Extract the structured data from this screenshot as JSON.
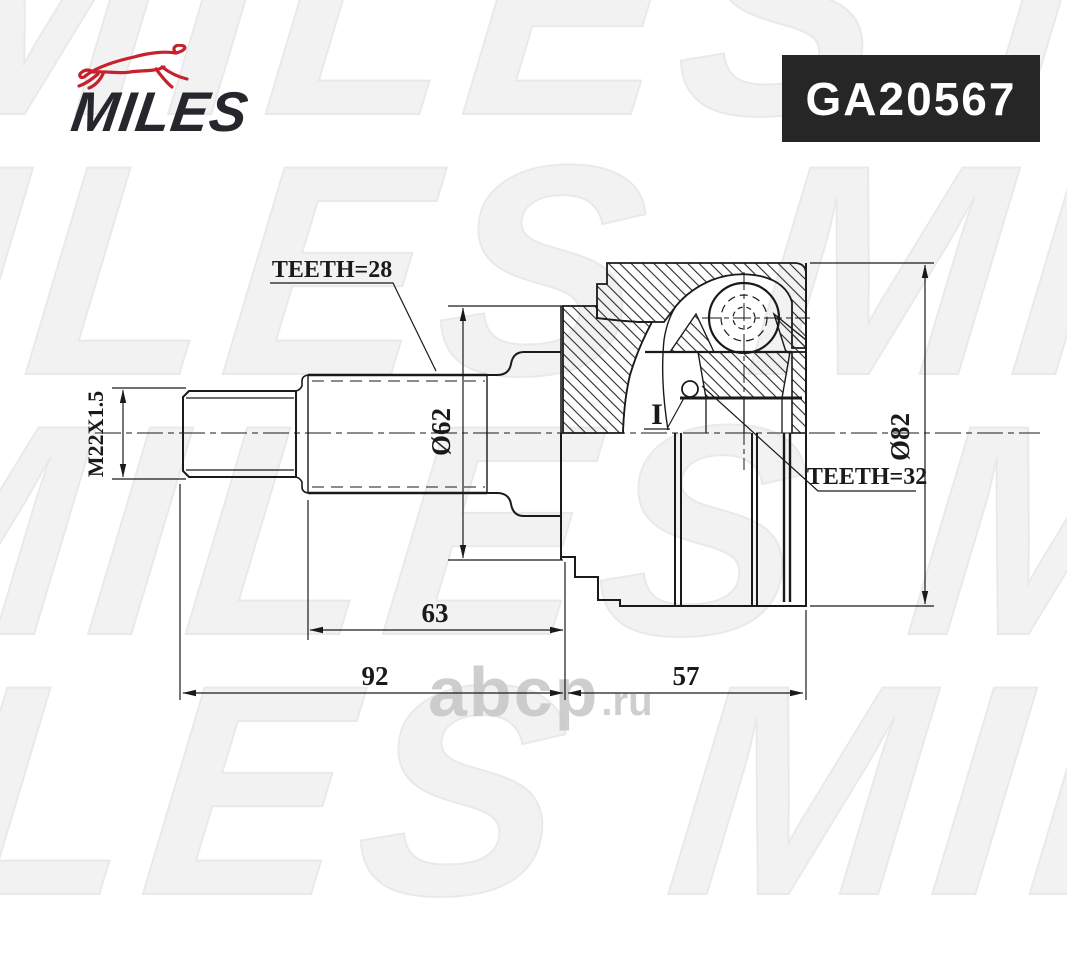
{
  "brand": {
    "name": "MILES",
    "logo_text_color": "#26272d",
    "dog_color": "#c5222c"
  },
  "badge": {
    "part_number": "GA20567",
    "bg_color": "#262626",
    "text_color": "#ffffff"
  },
  "watermarks": {
    "pattern_text": "MILES MILES",
    "site": "abcp",
    "site_suffix": ".ru"
  },
  "drawing": {
    "line_color": "#1a1a1a",
    "labels": {
      "teeth_outer": "TEETH=28",
      "thread_spec": "M22X1.5",
      "diameter_inner": "Ø62",
      "diameter_outer": "Ø82",
      "teeth_inner": "TEETH=32",
      "detail_marker": "I",
      "length_spline": "63",
      "length_shaft": "92",
      "length_body": "57"
    },
    "dimensions_mm": {
      "outer_spline_teeth": 28,
      "inner_spline_teeth": 32,
      "thread": "M22X1.5",
      "small_diameter": 62,
      "outer_diameter": 82,
      "spline_section_length": 63,
      "shaft_length": 92,
      "body_length": 57
    }
  }
}
